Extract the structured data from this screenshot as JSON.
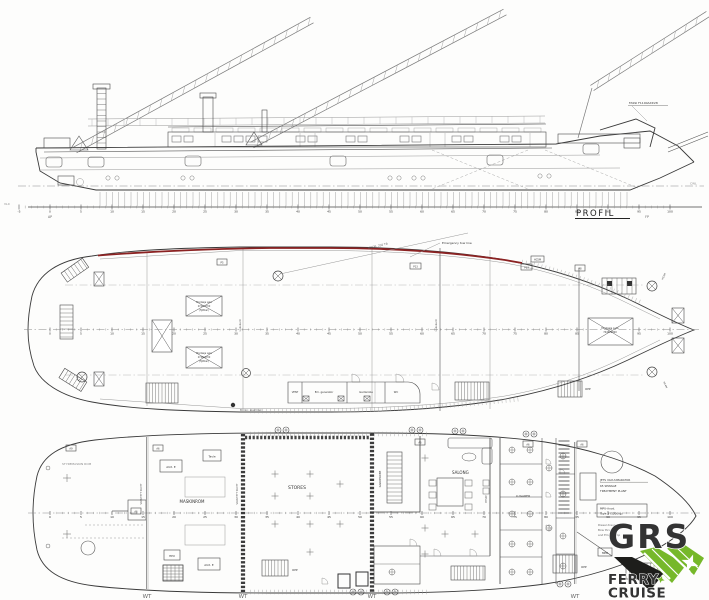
{
  "colors": {
    "ink": "#3a3a3a",
    "tow_line": "#8b2222",
    "logo_green": "#76b82a",
    "logo_dark": "#1d1d1b"
  },
  "profile": {
    "view_label": "PROFIL",
    "crane_label": "FASSI F1100AXP.28",
    "ap_label": "AP",
    "fp_label": "FP",
    "cwl_label": "CWL",
    "baseline_label": "VL0",
    "frame_labels": [
      "-5",
      "0",
      "5",
      "10",
      "15",
      "20",
      "25",
      "30",
      "35",
      "40",
      "45",
      "50",
      "55",
      "60",
      "65",
      "70",
      "75",
      "80",
      "85",
      "90",
      "95",
      "100"
    ]
  },
  "main_deck": {
    "mooring_line_label": "MOOR. 250 TB",
    "tow_line_label": "Emergency tow line",
    "hatch_small": [
      "Montasje Luke",
      "2740x1700",
      "(flyttbar)"
    ],
    "hatch_fore": [
      "Montasje Luke",
      "7440x1820"
    ],
    "rooms": {
      "vent": "VENT",
      "generator": "Em. generator",
      "wardrobe": "Garderobe",
      "wc": "WC"
    },
    "stair_label": "OPP",
    "coaming_label": "Lukekarm",
    "winch_note": "Bunkr. elektrisk",
    "deck_codes": [
      "P5",
      "P13",
      "P13",
      "P8",
      "HC5M"
    ],
    "bow_code": "HC4M",
    "frame_labels": [
      "0",
      "5",
      "10",
      "15",
      "20",
      "25",
      "30",
      "35",
      "40",
      "45",
      "50",
      "55",
      "60",
      "65",
      "70",
      "75",
      "80",
      "85",
      "90",
      "95",
      "100"
    ]
  },
  "lower_deck": {
    "steering_room": "STYREMASKIN ROM",
    "engine_room": "MASKINROM",
    "aux_1": "AUX. E",
    "aux_2": "AUX. E",
    "switchboard": "Tavle",
    "hpu": "HPU",
    "stores": "STORES",
    "wardrobe": "GARDEROBE",
    "saloon": "SALONG",
    "cabins": "LUGARER",
    "galley": "BYSSE",
    "bulkhead_label": "VANNTETT SKOTT",
    "wt_labels": [
      "WT",
      "WT",
      "WT",
      "WT"
    ],
    "sewage_note": [
      "JETS VACUUMARATOR",
      "65 SEWAGE",
      "TREATMENT PLANT"
    ],
    "anode_box": [
      "MPU-Anod.",
      "Type 3 (1200kg)"
    ],
    "thruster_note": [
      "Diesel drevet",
      "Bow thruster",
      "and Em. f.pump"
    ],
    "mpb_box": "MPB",
    "stair_labels": [
      "OPP",
      "OPP",
      "OPP"
    ],
    "code_boxes": [
      "A9",
      "A6",
      "A6",
      "A6",
      "A6",
      "A6"
    ],
    "frame_labels": [
      "0",
      "5",
      "10",
      "15",
      "20",
      "25",
      "30",
      "35",
      "40",
      "45",
      "50",
      "55",
      "60",
      "65",
      "70",
      "75",
      "80",
      "85",
      "90",
      "95",
      "100"
    ]
  },
  "logo": {
    "brand": "GRS",
    "tagline_1": "FERRY",
    "tagline_2": "CRUISE"
  }
}
